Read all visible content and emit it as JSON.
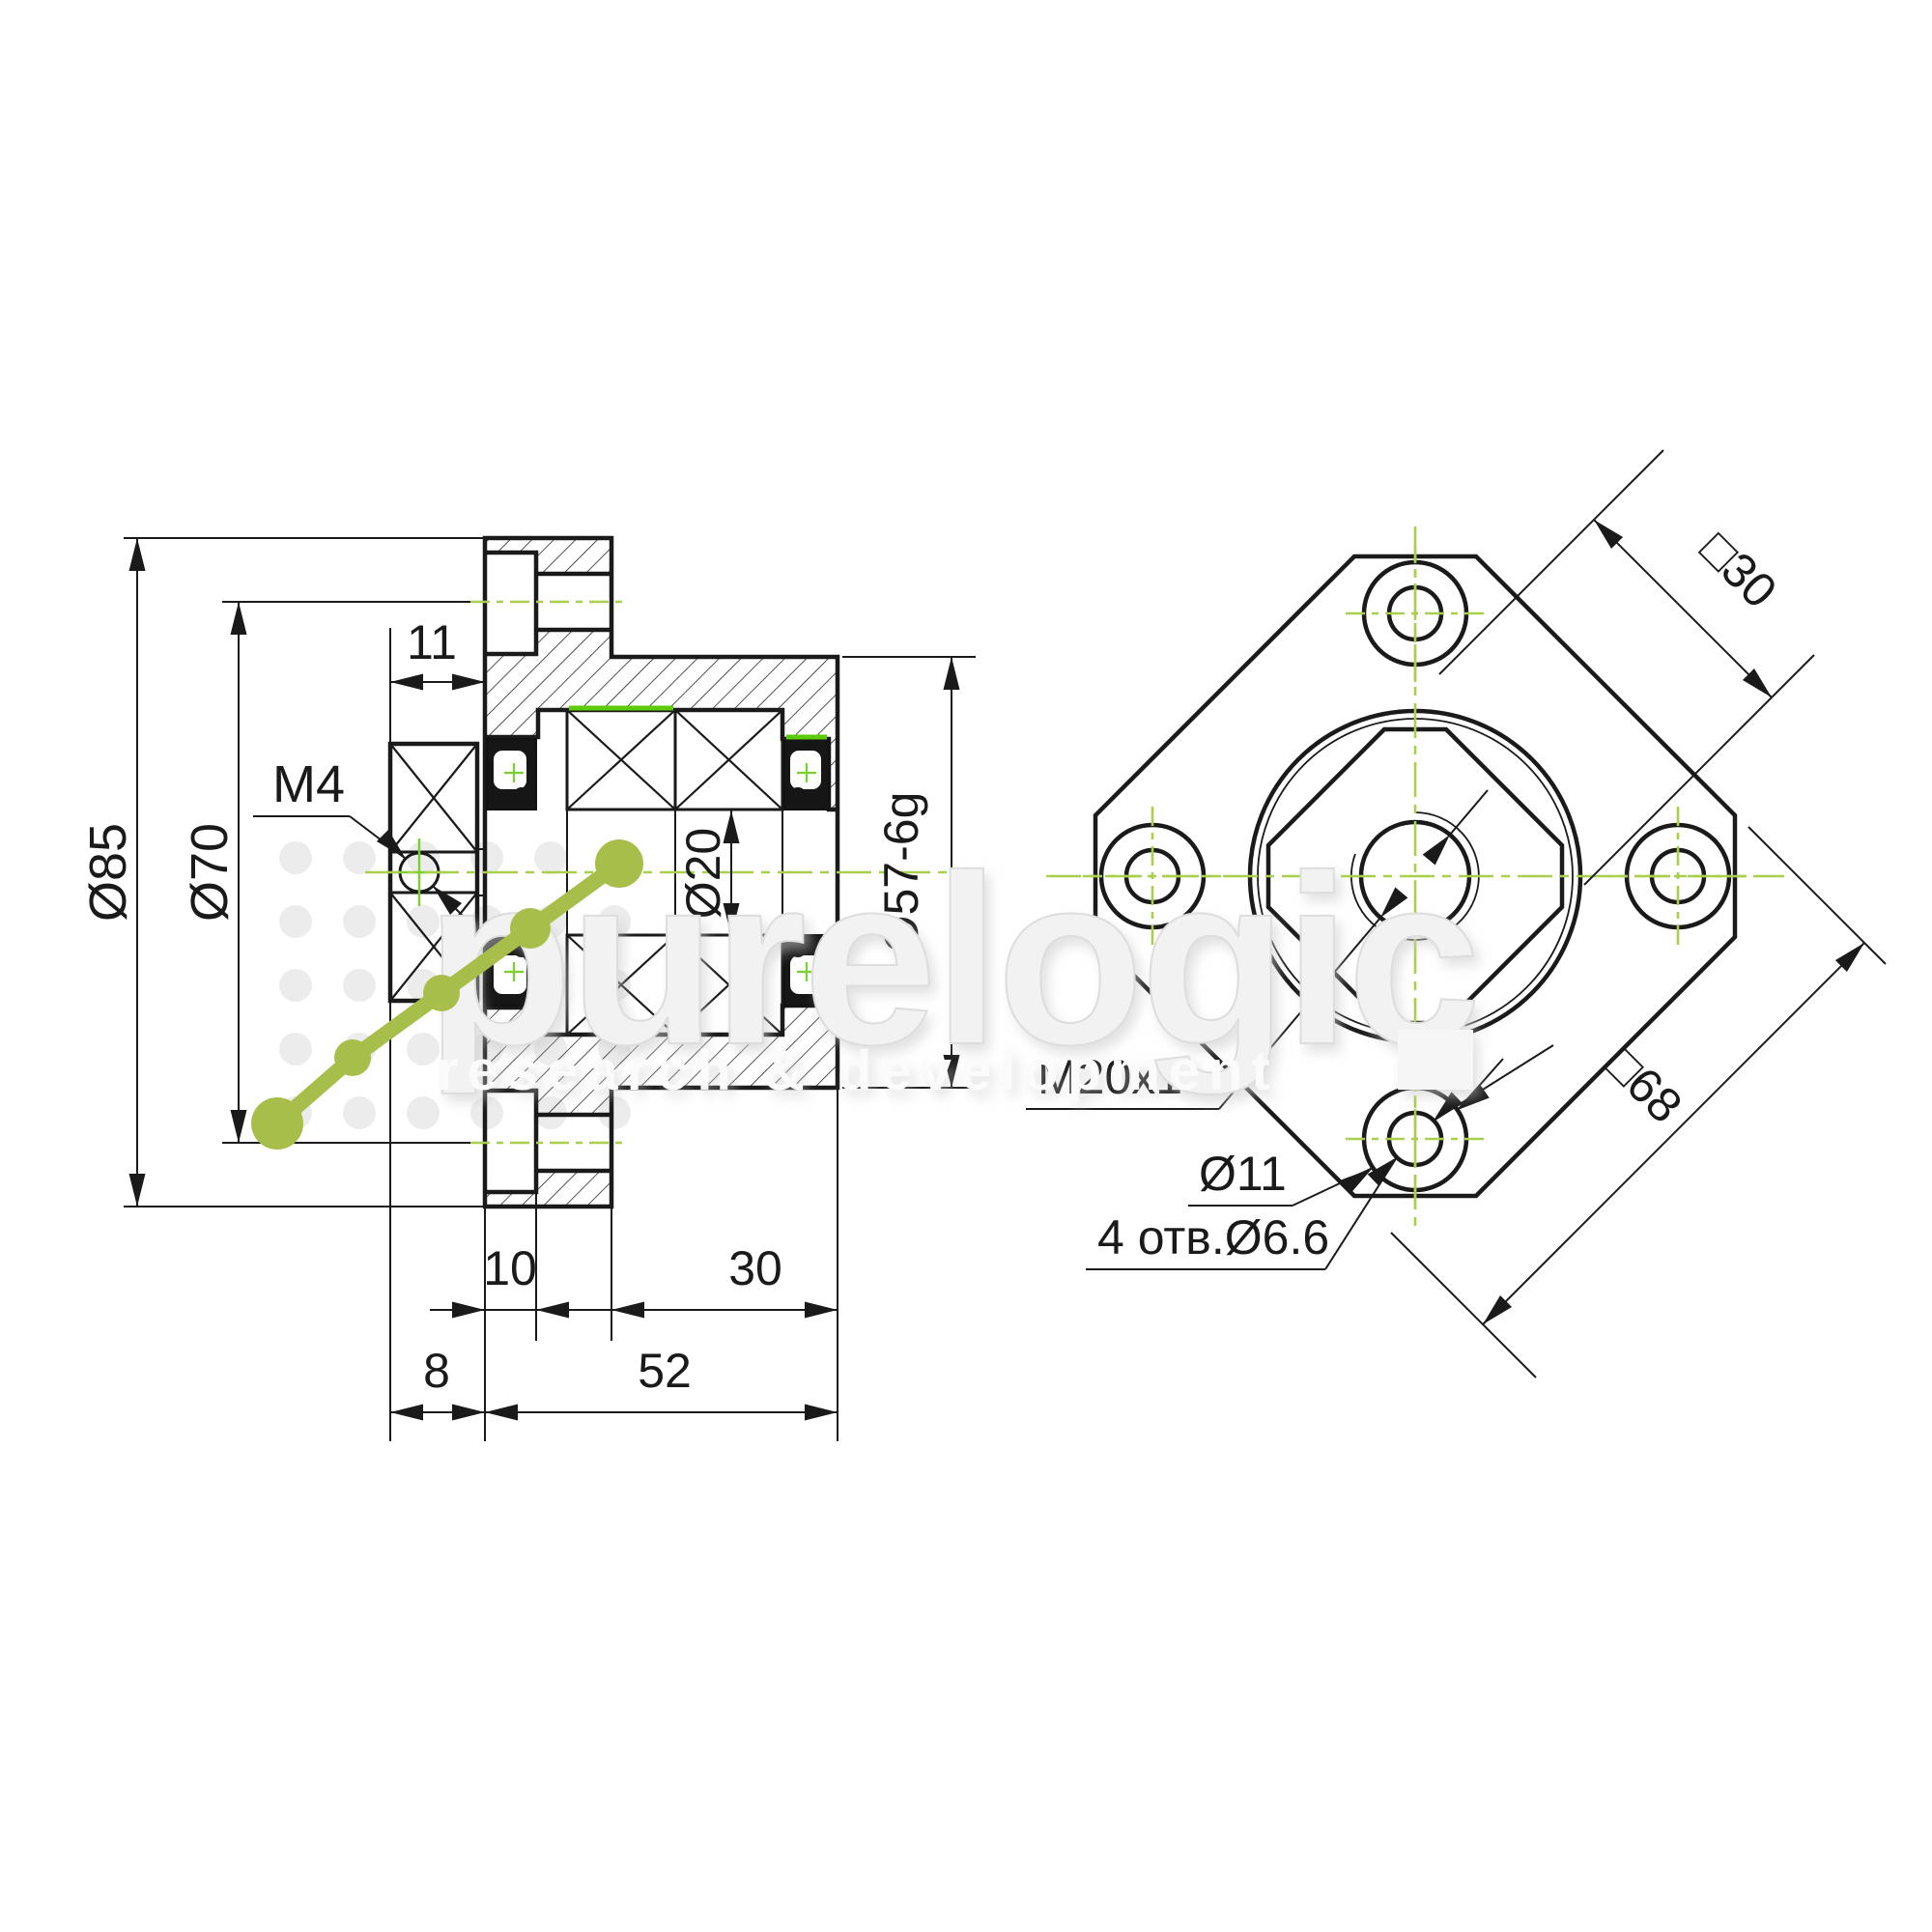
{
  "title": "FK bearing support unit drawing",
  "watermark": {
    "brand": "purelogic",
    "tagline": "research & development"
  },
  "dimensions": {
    "flange_od": "Ø85",
    "bolt_circle": "Ø70",
    "nut_width": "11",
    "set_screw": "M4",
    "bore": "Ø20",
    "pilot": "Ø57-6g",
    "counterbore_depth": "10",
    "body_length": "30",
    "nut_offset": "8",
    "overall_length": "52",
    "nut_flats": "□30",
    "flange_square": "□68",
    "center_thread": "M20x1",
    "counterbore_dia": "Ø11",
    "mounting_holes": "4 отв.Ø6.6"
  },
  "colors": {
    "line": "#1a1a1a",
    "centerline": "#a9cf4d",
    "highlight": "#5ecb0a",
    "logo_green": "#a7bf4a",
    "watermark_gray": "#ededed"
  }
}
